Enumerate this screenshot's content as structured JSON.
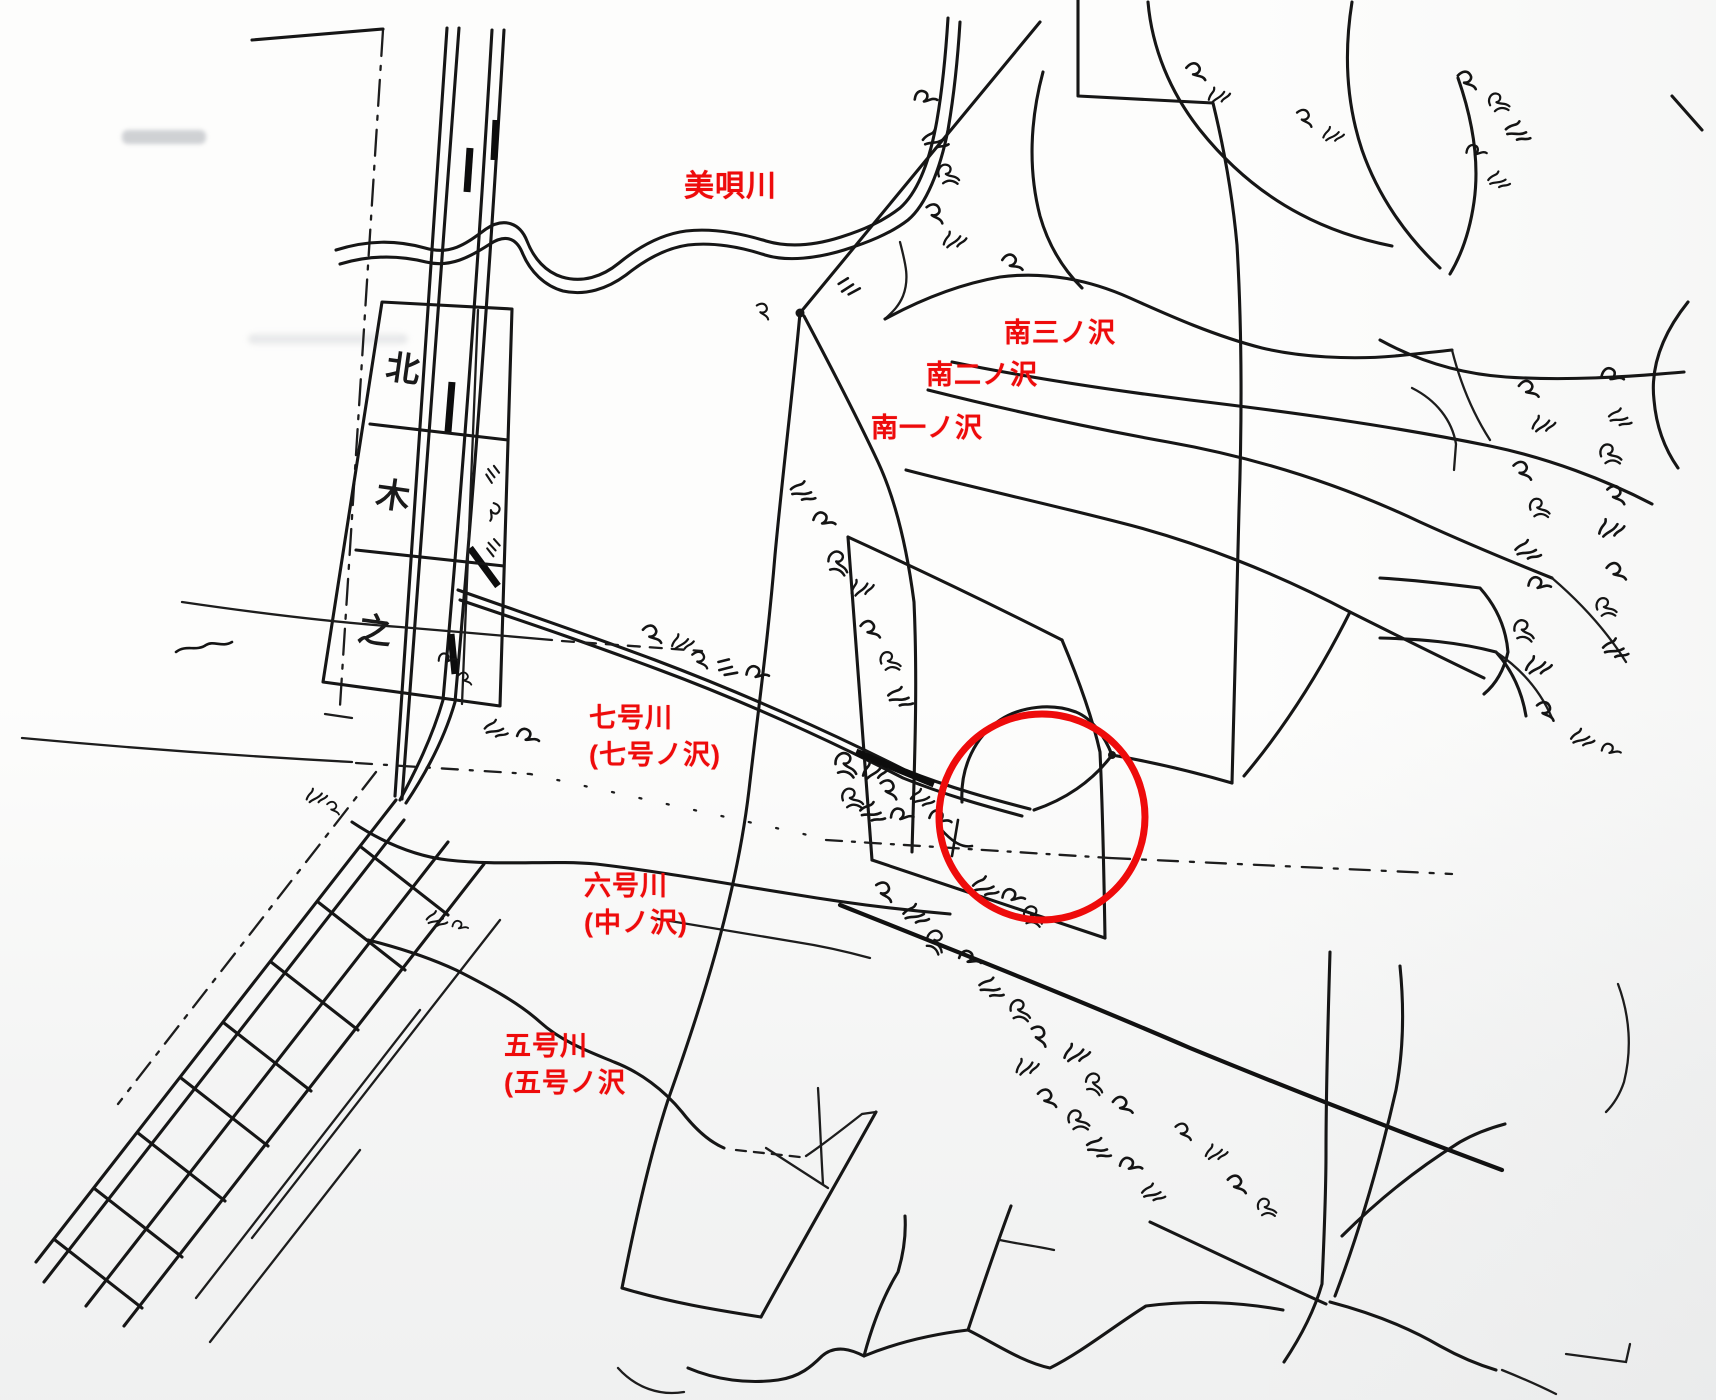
{
  "labels": {
    "bibai_river": "美唄川",
    "minami_san_no_sawa": "南三ノ沢",
    "minami_ni_no_sawa": "南二ノ沢",
    "minami_ichi_no_sawa": "南一ノ沢",
    "nanago_river": "七号川",
    "nanago_sawa_paren": "(七号ノ沢)",
    "rokugo_river": "六号川",
    "naka_no_sawa_paren": "(中ノ沢)",
    "gogo_river": "五号川",
    "gogo_sawa_paren": "(五号ノ沢"
  },
  "map_text": {
    "grid_cell_top": "北",
    "grid_cell_middle": "木",
    "grid_cell_bottom": "之"
  },
  "colors": {
    "annotation_red": "#ee0b0b",
    "ink_black": "#161616",
    "paper_white": "#fdfdfc"
  }
}
